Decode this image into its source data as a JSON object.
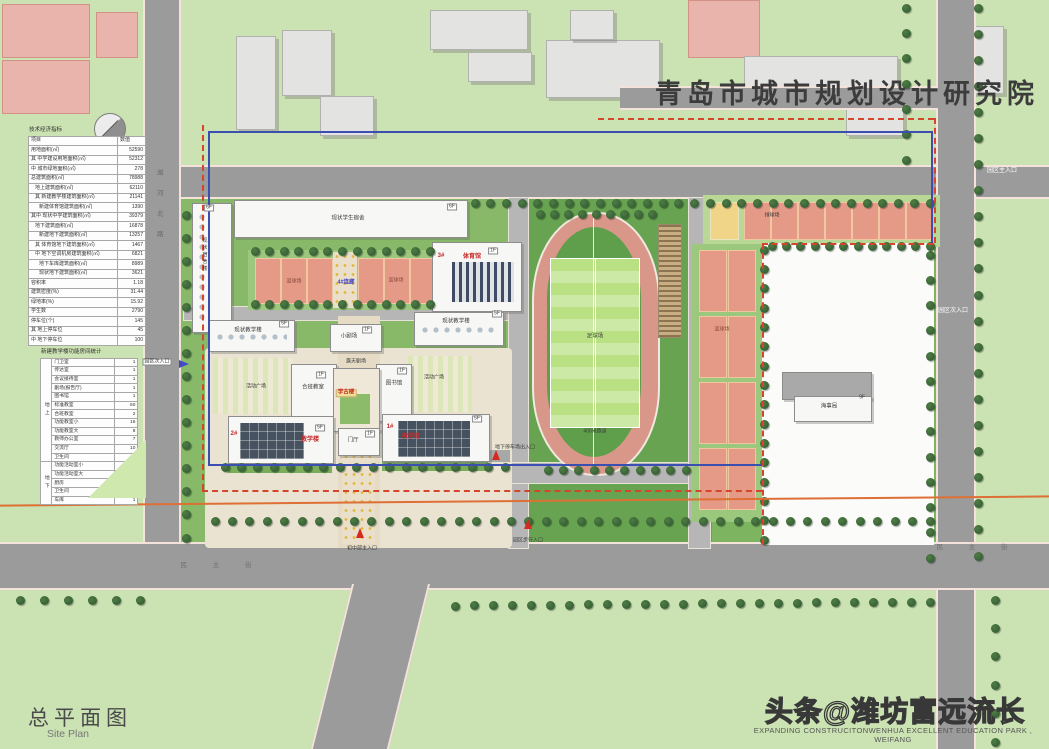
{
  "header": {
    "institute": "青岛市城市规划设计研究院"
  },
  "footer": {
    "title_cn": "总平面图",
    "title_en": "Site Plan",
    "watermark_cn": "头条@潍坊富远流长",
    "watermark_en": "EXPANDING CONSTRUCITONWENHUA EXCELLENT EDUCATION PARK , WEIFANG"
  },
  "indicator_table": {
    "title": "技术经济指标",
    "col_item": "项目",
    "col_value": "数值",
    "rows": [
      {
        "l": "用地面积(㎡)",
        "v": "52590",
        "i": 0
      },
      {
        "l": "其 中学建设用地面积(㎡)",
        "v": "52312",
        "i": 0
      },
      {
        "l": "中 城市绿地面积(㎡)",
        "v": "278",
        "i": 0
      },
      {
        "l": "总建筑面积(㎡)",
        "v": "78988",
        "i": 0
      },
      {
        "l": "地上建筑面积(㎡)",
        "v": "62110",
        "i": 1
      },
      {
        "l": "其 新建教学楼建筑面积(㎡)",
        "v": "21141",
        "i": 1
      },
      {
        "l": "新建体育馆建筑面积(㎡)",
        "v": "1390",
        "i": 2
      },
      {
        "l": "其中 现状中学建筑面积(㎡)",
        "v": "39379",
        "i": 0
      },
      {
        "l": "地下建筑面积(㎡)",
        "v": "16878",
        "i": 1
      },
      {
        "l": "新建地下建筑面积(㎡)",
        "v": "13257",
        "i": 2
      },
      {
        "l": "其 体育馆地下建筑面积(㎡)",
        "v": "1467",
        "i": 1
      },
      {
        "l": "中 地下空调机房建筑面积(㎡)",
        "v": "6821",
        "i": 1
      },
      {
        "l": "地下车库建筑面积(㎡)",
        "v": "8989",
        "i": 2
      },
      {
        "l": "现状地下建筑面积(㎡)",
        "v": "3621",
        "i": 2
      },
      {
        "l": "容积率",
        "v": "1.18",
        "i": 0
      },
      {
        "l": "建筑密度(%)",
        "v": "31.44",
        "i": 0
      },
      {
        "l": "绿地率(%)",
        "v": "15.92",
        "i": 0
      },
      {
        "l": "学生数",
        "v": "2790",
        "i": 0
      },
      {
        "l": "停车位(个)",
        "v": "145",
        "i": 0
      },
      {
        "l": "其 地上停车位",
        "v": "45",
        "i": 0
      },
      {
        "l": "中 地下停车位",
        "v": "100",
        "i": 0
      }
    ]
  },
  "room_table": {
    "title": "新建教学楼功能房间统计",
    "sections": [
      {
        "group": "地上",
        "rows": [
          [
            "门卫室",
            "1"
          ],
          [
            "传达室",
            "1"
          ],
          [
            "会议接待室",
            "1"
          ],
          [
            "剧场(报告厅)",
            "1"
          ],
          [
            "图书馆",
            "1"
          ],
          [
            "标准教室",
            "60"
          ],
          [
            "合班教室",
            "2"
          ],
          [
            "功能教室小",
            "16"
          ],
          [
            "功能教室大",
            "8"
          ],
          [
            "教师办公室",
            "7"
          ],
          [
            "交流厅",
            "10"
          ],
          [
            "卫生间",
            "11"
          ]
        ]
      },
      {
        "group": "地下",
        "rows": [
          [
            "功能活动室小",
            "4"
          ],
          [
            "功能活动室大",
            "17"
          ],
          [
            "厨房",
            "4"
          ],
          [
            "卫生间",
            "2"
          ],
          [
            "车库",
            "1"
          ]
        ]
      }
    ]
  },
  "map": {
    "labels": [
      {
        "t": "现状学生宿舍",
        "x": 348,
        "y": 219,
        "cls": "",
        "name": "label-existing-dorm"
      },
      {
        "t": "6F",
        "x": 209,
        "y": 208,
        "cls": "tag",
        "name": "floor-tag"
      },
      {
        "t": "6F",
        "x": 452,
        "y": 207,
        "cls": "tag",
        "name": "floor-tag"
      },
      {
        "t": "现状宿舍楼",
        "x": 204,
        "y": 255,
        "cls": "vert tiny",
        "name": "label-existing-dorm-left"
      },
      {
        "t": "篮球场",
        "x": 294,
        "y": 282,
        "cls": "courtlabel",
        "name": "label-basketball"
      },
      {
        "t": "篮球场",
        "x": 396,
        "y": 281,
        "cls": "courtlabel",
        "name": "label-basketball"
      },
      {
        "t": "4#连廊",
        "x": 346,
        "y": 283,
        "cls": "blue",
        "name": "label-corridor-4"
      },
      {
        "t": "3#",
        "x": 441,
        "y": 256,
        "cls": "red",
        "name": "label-building-3"
      },
      {
        "t": "体育馆",
        "x": 472,
        "y": 257,
        "cls": "red",
        "name": "label-gym"
      },
      {
        "t": "1F",
        "x": 493,
        "y": 251,
        "cls": "tag",
        "name": "floor-tag"
      },
      {
        "t": "现状教学楼",
        "x": 248,
        "y": 331,
        "cls": "",
        "name": "label-existing-teaching"
      },
      {
        "t": "5F",
        "x": 284,
        "y": 324,
        "cls": "tag",
        "name": "floor-tag"
      },
      {
        "t": "现状教学楼",
        "x": 456,
        "y": 322,
        "cls": "",
        "name": "label-existing-teaching"
      },
      {
        "t": "5F",
        "x": 497,
        "y": 314,
        "cls": "tag",
        "name": "floor-tag"
      },
      {
        "t": "小剧场",
        "x": 349,
        "y": 337,
        "cls": "",
        "name": "label-small-theater"
      },
      {
        "t": "1F",
        "x": 367,
        "y": 330,
        "cls": "tag",
        "name": "floor-tag"
      },
      {
        "t": "露天剧场",
        "x": 356,
        "y": 362,
        "cls": "tiny",
        "name": "label-open-theater"
      },
      {
        "t": "合班教室",
        "x": 313,
        "y": 388,
        "cls": "",
        "name": "label-combined-classroom"
      },
      {
        "t": "1F",
        "x": 321,
        "y": 375,
        "cls": "tag",
        "name": "floor-tag"
      },
      {
        "t": "图书馆",
        "x": 394,
        "y": 384,
        "cls": "",
        "name": "label-library"
      },
      {
        "t": "1F",
        "x": 402,
        "y": 371,
        "cls": "tag",
        "name": "floor-tag"
      },
      {
        "t": "学古楼",
        "x": 346,
        "y": 393,
        "cls": "yellowtag",
        "name": "label-xuegu-building"
      },
      {
        "t": "活动广场",
        "x": 256,
        "y": 387,
        "cls": "tiny",
        "name": "label-activity-plaza"
      },
      {
        "t": "活动广场",
        "x": 434,
        "y": 378,
        "cls": "tiny",
        "name": "label-activity-plaza"
      },
      {
        "t": "2#",
        "x": 234,
        "y": 434,
        "cls": "red",
        "name": "label-building-2"
      },
      {
        "t": "教学楼",
        "x": 310,
        "y": 440,
        "cls": "red",
        "name": "label-teaching-building"
      },
      {
        "t": "5F",
        "x": 320,
        "y": 428,
        "cls": "tag",
        "name": "floor-tag"
      },
      {
        "t": "1#",
        "x": 390,
        "y": 427,
        "cls": "red",
        "name": "label-building-1"
      },
      {
        "t": "教学楼",
        "x": 411,
        "y": 437,
        "cls": "red",
        "name": "label-teaching-building"
      },
      {
        "t": "5F",
        "x": 477,
        "y": 419,
        "cls": "tag",
        "name": "floor-tag"
      },
      {
        "t": "门厅",
        "x": 353,
        "y": 441,
        "cls": "",
        "name": "label-entrance-hall"
      },
      {
        "t": "1F",
        "x": 370,
        "y": 434,
        "cls": "tag",
        "name": "floor-tag"
      },
      {
        "t": "足球场",
        "x": 595,
        "y": 337,
        "cls": "",
        "name": "label-football-field"
      },
      {
        "t": "400米跑道",
        "x": 595,
        "y": 432,
        "cls": "tiny",
        "name": "label-track-400m"
      },
      {
        "t": "排球场",
        "x": 772,
        "y": 216,
        "cls": "tiny",
        "name": "label-volleyball"
      },
      {
        "t": "篮球场",
        "x": 722,
        "y": 330,
        "cls": "courtlabel",
        "name": "label-basketball"
      },
      {
        "t": "海事局",
        "x": 829,
        "y": 407,
        "cls": "",
        "name": "label-maritime-bureau"
      },
      {
        "t": "9F",
        "x": 862,
        "y": 398,
        "cls": "tiny",
        "name": "floor-tag"
      },
      {
        "t": "园区主入口",
        "x": 1002,
        "y": 171,
        "cls": "white",
        "name": "entrance-label-main"
      },
      {
        "t": "园区次入口",
        "x": 953,
        "y": 311,
        "cls": "white",
        "name": "entrance-label-secondary"
      },
      {
        "t": "园区次入口",
        "x": 157,
        "y": 362,
        "cls": "tag",
        "name": "entrance-label-secondary"
      },
      {
        "t": "初中部主入口",
        "x": 362,
        "y": 549,
        "cls": "tiny",
        "name": "entrance-label-junior-high"
      },
      {
        "t": "园区步行入口",
        "x": 528,
        "y": 541,
        "cls": "tiny",
        "name": "entrance-label-pedestrian"
      },
      {
        "t": "地下停车场出入口",
        "x": 515,
        "y": 448,
        "cls": "tiny",
        "name": "entrance-label-parking"
      },
      {
        "t": "潍河北路",
        "x": 158,
        "y": 210,
        "cls": "vroad",
        "name": "road-name-west"
      },
      {
        "t": "民 主 街",
        "x": 222,
        "y": 566,
        "cls": "roadname",
        "name": "road-name-south"
      },
      {
        "t": "民 主 街",
        "x": 978,
        "y": 548,
        "cls": "roadname",
        "name": "road-name-south"
      }
    ],
    "arrows": [
      {
        "x": 360,
        "y": 533,
        "dir": "up",
        "name": "entrance-arrow-junior-high"
      },
      {
        "x": 528,
        "y": 524,
        "dir": "up",
        "name": "entrance-arrow-pedestrian"
      },
      {
        "x": 496,
        "y": 455,
        "dir": "up",
        "name": "entrance-arrow-parking"
      },
      {
        "x": 184,
        "y": 364,
        "dir": "right",
        "name": "entrance-arrow-secondary"
      }
    ],
    "colors": {
      "site_boundary_red": "#d4452a",
      "boundary_blue": "#3a4fb0",
      "utility_orange": "#de6f35",
      "track": "#d9978a",
      "pitch": "#b9e183",
      "court_orange": "#e59a88",
      "court_yellow": "#f0d488",
      "road_gray": "#9b9b9b"
    }
  }
}
